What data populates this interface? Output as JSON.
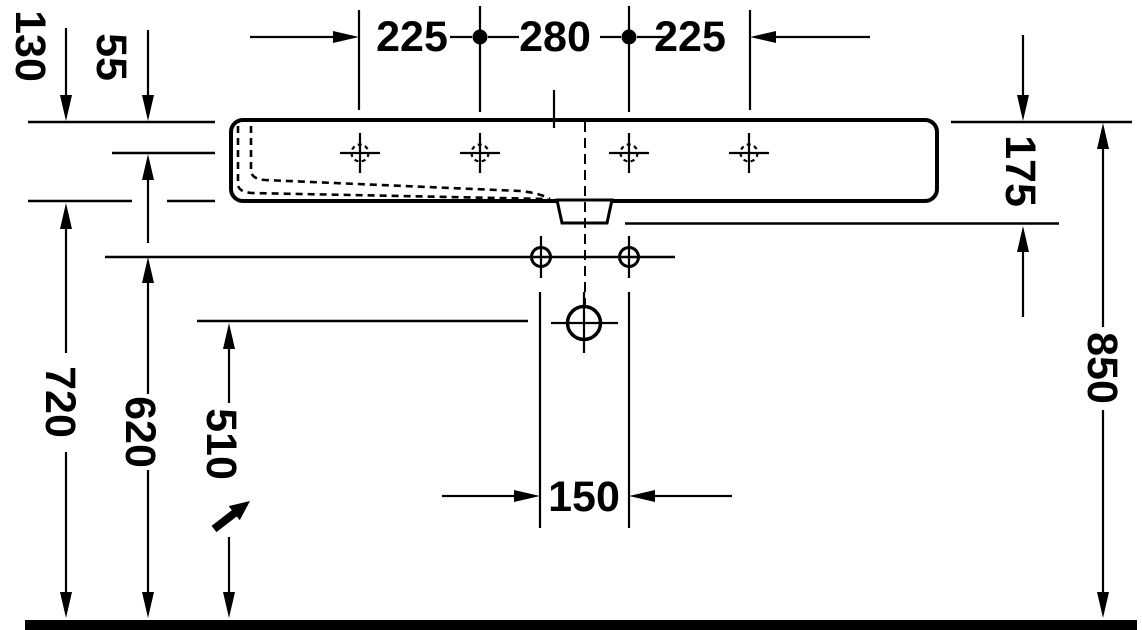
{
  "drawing": {
    "type": "washbasin technical dimension drawing (front section view)",
    "unit": "mm",
    "labels": {
      "v130": "130",
      "v55": "55",
      "v225a": "225",
      "v280": "280",
      "v225b": "225",
      "v175": "175",
      "v850": "850",
      "v720": "720",
      "v620": "620",
      "v510": "510",
      "v150": "150"
    },
    "dimensions": {
      "basin_edge_height": "130",
      "rim_to_inner_ledge": "55",
      "tap_hole_spacing_left": "225",
      "tap_hole_spacing_center": "280",
      "tap_hole_spacing_right": "225",
      "rim_to_outlet_bottom": "175",
      "rim_height_above_floor": "850",
      "basin_underside_height": "720",
      "fixing_hole_height": "620",
      "drain_center_height": "510",
      "fixing_hole_spacing": "150"
    },
    "colors": {
      "line": "#000000",
      "background": "#ffffff"
    }
  }
}
